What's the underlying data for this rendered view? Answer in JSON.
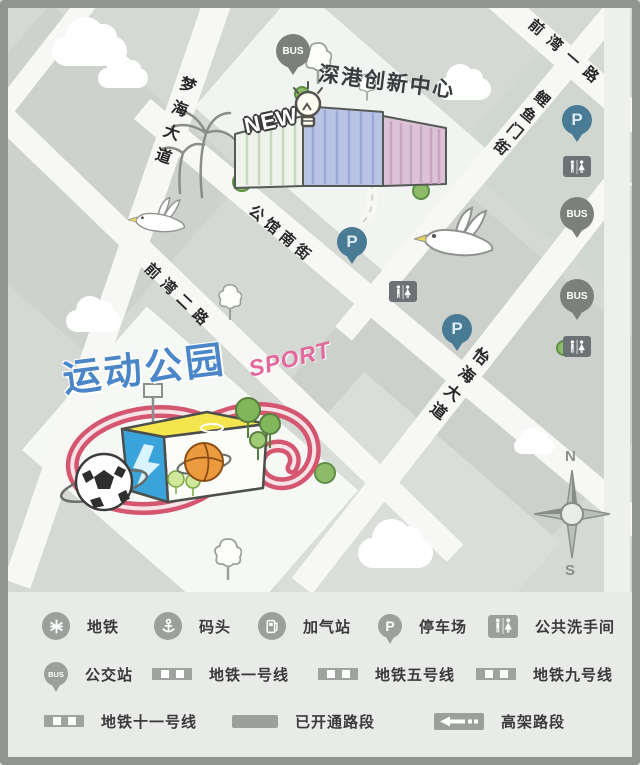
{
  "map": {
    "streets": [
      {
        "name": "前湾一路"
      },
      {
        "name": "鲤鱼门街"
      },
      {
        "name": "梦海大道"
      },
      {
        "name": "公馆南街"
      },
      {
        "name": "前湾二路"
      },
      {
        "name": "怡海大道"
      }
    ],
    "innovation_center": {
      "title": "深港创新中心",
      "badge": "NEW"
    },
    "sports_park": {
      "title": "运动公园",
      "badge": "SPORT"
    },
    "pins": {
      "bus_label": "BUS",
      "parking_label": "P"
    },
    "compass": {
      "north": "N",
      "south": "S"
    }
  },
  "legend": {
    "metro": "地铁",
    "dock": "码头",
    "gas": "加气站",
    "parking": "停车场",
    "restroom": "公共洗手间",
    "bus": "公交站",
    "line1": "地铁一号线",
    "line5": "地铁五号线",
    "line9": "地铁九号线",
    "line11": "地铁十一号线",
    "opened": "已开通路段",
    "elevated": "高架路段"
  },
  "colors": {
    "frame_gray": "#90958f",
    "block_gray": "#d4d9d3",
    "road_white": "#f7f8f5",
    "parking_pin_blue": "#4a7b95",
    "bus_pin_gray": "#7b807b",
    "restroom_gray": "#6d7276",
    "legend_icon_gray": "#9ba09b",
    "park_title_blue": "#4a86c8",
    "sport_pink": "#e2679d",
    "track_pink": "#d4566f"
  }
}
